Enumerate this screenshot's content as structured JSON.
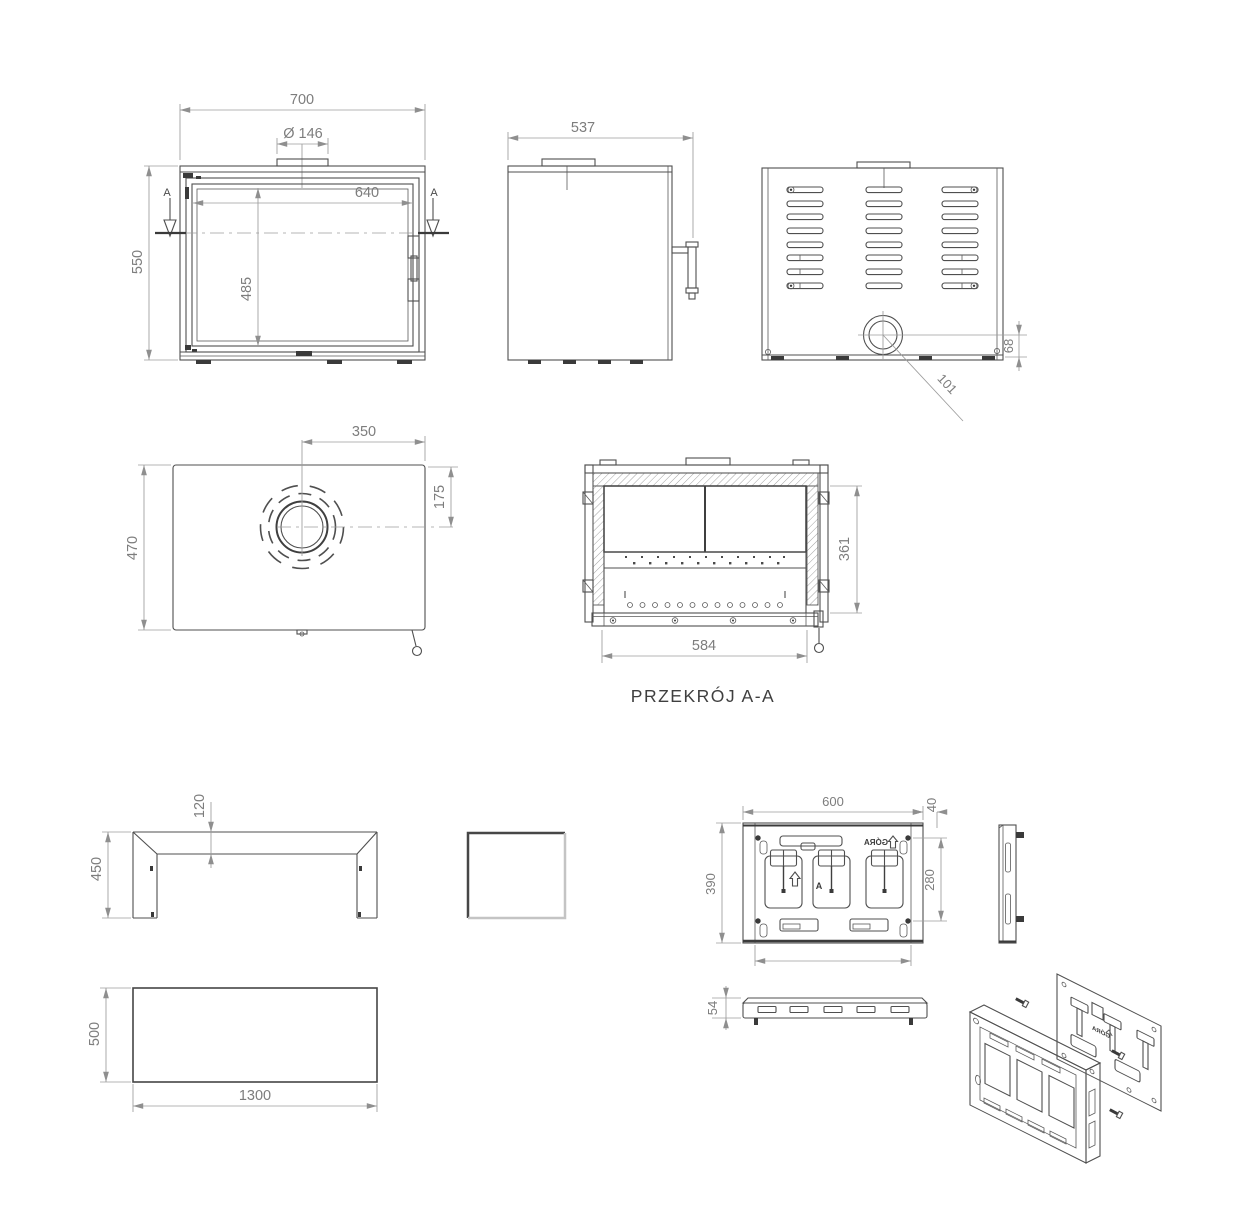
{
  "meta": {
    "background": "#ffffff",
    "line_color": "#4f4f4f",
    "dim_color": "#9c9c9c",
    "dim_text_color": "#7d7d7d",
    "caption_color": "#3f3f3f"
  },
  "views": {
    "front": {
      "dim_width": "700",
      "dim_flue_diameter": "Ø 146",
      "dim_inner_width": "640",
      "dim_height": "550",
      "dim_inner_height": "485",
      "section_marker": "A"
    },
    "side": {
      "dim_depth": "537"
    },
    "back": {
      "dim_outlet_diagonal": "101",
      "dim_outlet_height": "68"
    },
    "top": {
      "dim_flue_center_from_right": "350",
      "dim_flue_center_from_front": "175",
      "dim_depth": "470"
    },
    "section_aa": {
      "caption": "PRZEKRÓJ A-A",
      "dim_opening_width": "584",
      "dim_opening_height": "361"
    },
    "stand_frame": {
      "dim_profile": "120",
      "dim_height": "450"
    },
    "base_plate": {
      "dim_depth": "500",
      "dim_width": "1300"
    },
    "mount_plate": {
      "dim_width": "600",
      "dim_offset": "40",
      "dim_height": "390",
      "dim_inner_height": "280",
      "orientation_text": "GÓRA",
      "letter": "A"
    },
    "grille_bar": {
      "dim_height": "54"
    },
    "exploded": {
      "orientation_text": "GÓRA"
    }
  }
}
